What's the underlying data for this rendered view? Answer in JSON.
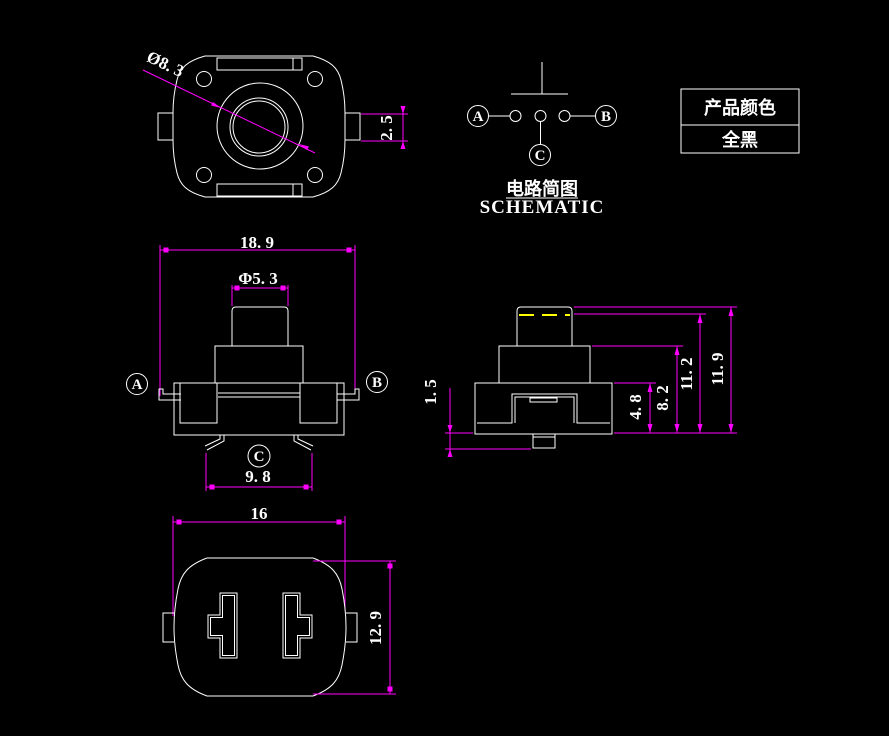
{
  "colors": {
    "background": "#000000",
    "geometry_line": "#ffffff",
    "dimension_line": "#ff00ff",
    "highlight_dash": "#ffff00",
    "text": "#ffffff"
  },
  "top_view": {
    "dim_diameter": "Ø8. 3",
    "dim_tab_width": "2. 5"
  },
  "front_view": {
    "dim_total_width": "18. 9",
    "dim_button_diameter": "Φ5. 3",
    "dim_pin_span": "9. 8",
    "label_a": "A",
    "label_b": "B",
    "label_c": "C"
  },
  "side_view": {
    "dim_pin_length": "1. 5",
    "dim_base_height": "4. 8",
    "dim_mid_height": "8. 2",
    "dim_pressed_height": "11. 2",
    "dim_total_height": "11. 9"
  },
  "bottom_view": {
    "dim_width": "16",
    "dim_height": "12. 9"
  },
  "schematic": {
    "label_a": "A",
    "label_b": "B",
    "label_c": "C",
    "title_cn": "电路简图",
    "title_en": "SCHEMATIC"
  },
  "color_table": {
    "header": "产品颜色",
    "value": "全黑"
  }
}
